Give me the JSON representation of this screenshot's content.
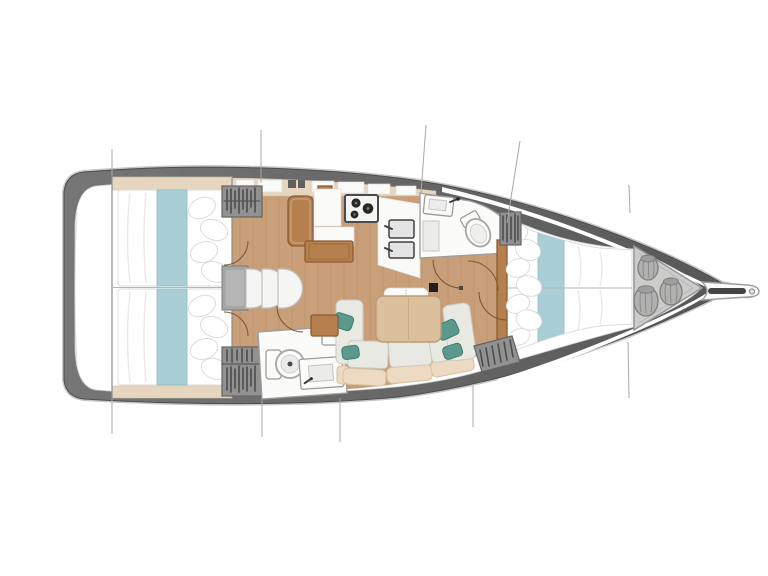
{
  "diagram": {
    "type": "sailboat-interior-deck-plan",
    "view": "top-down",
    "orientation": {
      "bow": "right",
      "stern": "left"
    },
    "background": "#ffffff"
  },
  "palette": {
    "hull_band": "#767676",
    "hull_band_dark": "#565656",
    "hull_edge": "#4d4d4d",
    "rail": "#c6c6c6",
    "deck_white": "#ffffff",
    "interior_edge": "#c9c9c9",
    "floor_wood": "#c89f79",
    "floor_grain": "rgba(120,80,45,0.10)",
    "trim_beige": "#e6d5bf",
    "trim_edge": "#d2bda0",
    "wood_furniture": "#b5804e",
    "wood_edge": "#8a5c33",
    "table_wood": "#dcc09e",
    "table_edge": "#bb9c76",
    "mattress": "#ffffff",
    "mattress_line": "#dcdcdc",
    "fold_grey": "#e9e9e9",
    "runner_teal": "#a9ced6",
    "runner_edge": "#8fbcc6",
    "pillow_teal": "#5c998d",
    "pillow_teal_edge": "#417c70",
    "cushion": "#e9e9e3",
    "cushion_edge": "#cbcbc2",
    "back_cushion": "#eddac3",
    "back_edge": "#d8c1a1",
    "wardrobe_grey": "#919191",
    "wardrobe_edge": "#636363",
    "wardrobe_slat": "#4d4d4d",
    "locker_grey": "#cccccb",
    "locker_edge": "#969696",
    "bag_grey": "#b1b1b0",
    "bag_edge": "#7e7e7e",
    "bag_crease": "#8a8a8a",
    "fixture_white": "#fbfbfa",
    "fixture_edge": "#9c9c9c",
    "basin_grey": "#ececeb",
    "basin_edge": "#c6c6c6",
    "steel_dark": "#3c3c3c",
    "burner_black": "#262626",
    "door_arc": "#7d5a3c",
    "rig_line": "#a8a8a8",
    "mast_black": "#1f1f1f",
    "line_grey": "#b5b5b5",
    "bulkhead_grey": "#8e8e8e",
    "step_landing": "#a6a6a6",
    "step_white": "#f5f5f4"
  },
  "sections": [
    {
      "id": "stern-deck",
      "label": "Stern deck"
    },
    {
      "id": "aft-cabin-port",
      "label": "Aft cabin port",
      "features": [
        "double berth",
        "teal bed runner",
        "4 pillows",
        "hanging locker"
      ]
    },
    {
      "id": "aft-cabin-starboard",
      "label": "Aft cabin starboard",
      "features": [
        "double berth",
        "teal bed runner",
        "4 pillows",
        "hanging locker"
      ]
    },
    {
      "id": "companionway",
      "label": "Companionway",
      "features": [
        "landing",
        "3 curved steps"
      ]
    },
    {
      "id": "galley",
      "label": "Galley",
      "features": [
        "3-burner stove",
        "double sink",
        "worktop",
        "seat",
        "cutting board",
        "roof lockers"
      ]
    },
    {
      "id": "aft-head",
      "label": "Aft head",
      "features": [
        "toilet",
        "washbasin",
        "cabinet"
      ]
    },
    {
      "id": "saloon",
      "label": "Saloon",
      "features": [
        "U-shaped settee",
        "dining table",
        "bench seat",
        "side cabinet",
        "4 teal cushions"
      ]
    },
    {
      "id": "forward-head",
      "label": "Forward head",
      "features": [
        "toilet",
        "washbasin",
        "shower seat"
      ]
    },
    {
      "id": "forward-cabin",
      "label": "Forward cabin",
      "features": [
        "V-berth",
        "teal bed runner",
        "pillows",
        "2 hanging lockers"
      ]
    },
    {
      "id": "sail-locker",
      "label": "Sail locker",
      "features": [
        "3 sail bags"
      ]
    },
    {
      "id": "bowsprit",
      "label": "Bowsprit",
      "features": [
        "anchor roller"
      ]
    }
  ],
  "counts": {
    "cabins": 3,
    "heads": 2,
    "berths": 3,
    "stove_burners": 3,
    "galley_sinks": 2,
    "toilets": 2,
    "washbasins": 2,
    "sail_bags": 3,
    "companionway_steps": 3,
    "door_swings": 6,
    "hanging_lockers": 4,
    "rigging_lines": 10
  },
  "mast": {
    "present": true
  }
}
